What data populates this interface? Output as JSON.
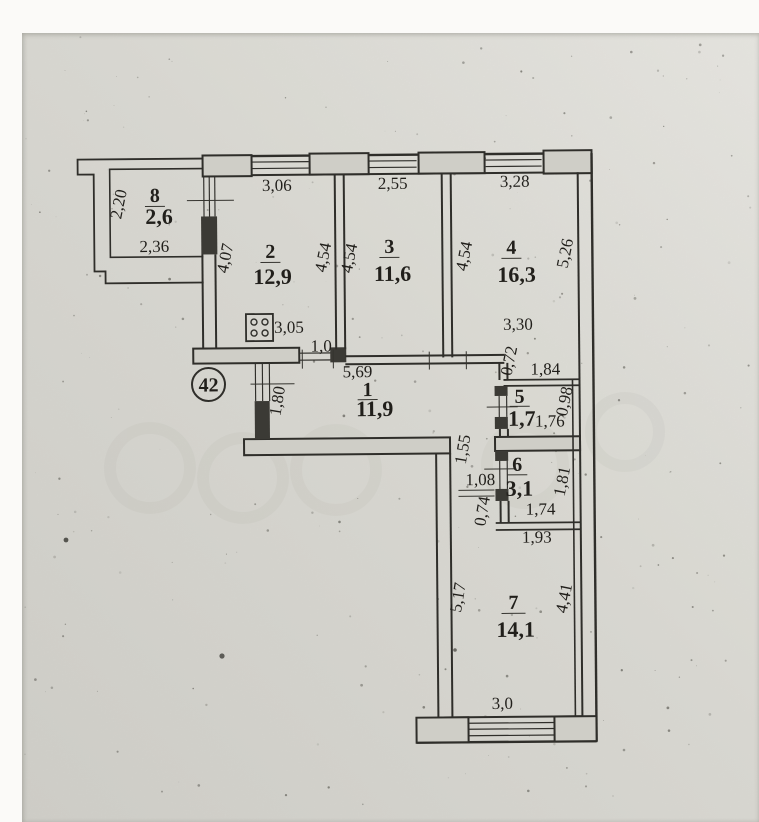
{
  "plan": {
    "apartment_number": "42",
    "rooms": {
      "r1": {
        "number": "1",
        "area": "11,9"
      },
      "r2": {
        "number": "2",
        "area": "12,9"
      },
      "r3": {
        "number": "3",
        "area": "11,6"
      },
      "r4": {
        "number": "4",
        "area": "16,3"
      },
      "r5": {
        "number": "5",
        "area": "1,7"
      },
      "r6": {
        "number": "6",
        "area": "3,1"
      },
      "r7": {
        "number": "7",
        "area": "14,1"
      },
      "r8": {
        "number": "8",
        "area": "2,6"
      }
    },
    "dims": {
      "balcony_depth": "2,20",
      "balcony_length": "2,36",
      "room2_top": "3,06",
      "room3_top": "2,55",
      "room4_top": "3,28",
      "room2_left": "4,07",
      "room2_right": "4,54",
      "room3_left": "4,54",
      "room3_right": "4,54",
      "room4_right": "5,26",
      "kitchen_inner": "3,05",
      "kitchen_door": "1,0",
      "hall_width": "5,69",
      "room4_bottom": "3,30",
      "jog": "0,72",
      "room5_top": "1,84",
      "room5_right": "0,98",
      "room5_bottom": "1,76",
      "entry_wall": "1,80",
      "corridor_upper": "1,55",
      "corridor_door": "1,08",
      "corridor_lower": "0,74",
      "room6_right": "1,81",
      "room6_bottom": "1,74",
      "room6_wall": "1,93",
      "room7_left": "5,17",
      "room7_right": "4,41",
      "room7_bottom": "3,0"
    }
  }
}
